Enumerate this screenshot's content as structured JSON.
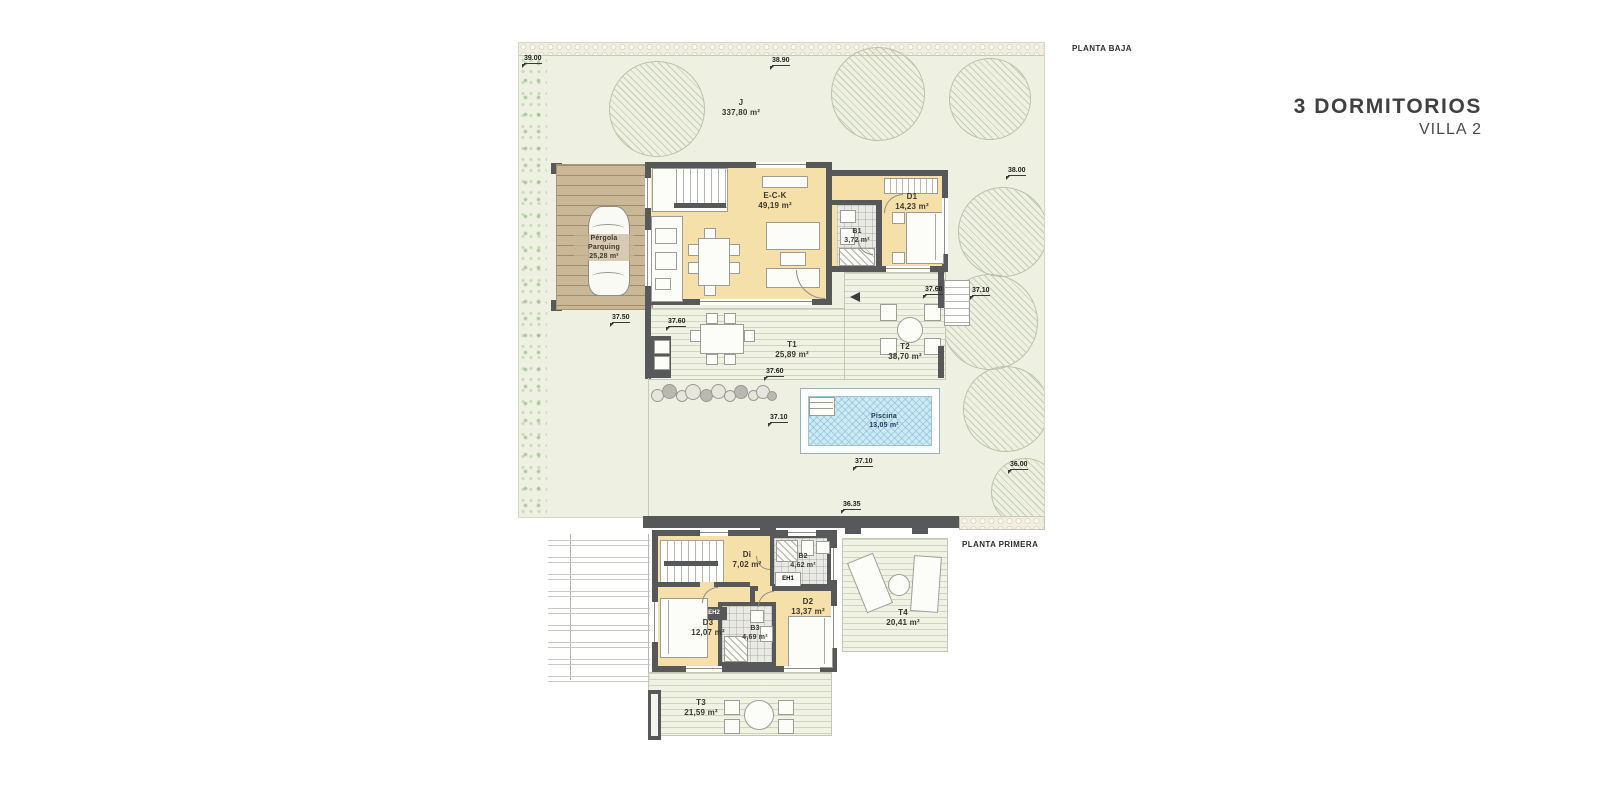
{
  "title": {
    "line1": "3 DORMITORIOS",
    "line2": "VILLA 2"
  },
  "ground_floor": {
    "label": "PLANTA BAJA",
    "rooms": {
      "garden": {
        "name": "J",
        "area": "337,80 m²"
      },
      "pergola": {
        "name": "Pérgola",
        "name2": "Parquing",
        "area": "25,28 m²"
      },
      "living": {
        "name": "E-C-K",
        "area": "49,19 m²"
      },
      "bedroom1": {
        "name": "D1",
        "area": "14,23 m²"
      },
      "bath1": {
        "name": "B1",
        "area": "3,72 m²"
      },
      "terrace1": {
        "name": "T1",
        "area": "25,89 m²"
      },
      "terrace2": {
        "name": "T2",
        "area": "38,70 m²"
      },
      "pool": {
        "name": "Piscina",
        "area": "13,05 m²"
      }
    },
    "dimensions": [
      {
        "label": "39.00",
        "x": 524,
        "y": 55
      },
      {
        "label": "38.90",
        "x": 772,
        "y": 57
      },
      {
        "label": "38.00",
        "x": 1008,
        "y": 167
      },
      {
        "label": "37.60",
        "x": 925,
        "y": 286
      },
      {
        "label": "37.10",
        "x": 972,
        "y": 287
      },
      {
        "label": "37.50",
        "x": 612,
        "y": 314
      },
      {
        "label": "37.60",
        "x": 668,
        "y": 318
      },
      {
        "label": "37.60",
        "x": 766,
        "y": 368
      },
      {
        "label": "37.10",
        "x": 770,
        "y": 414
      },
      {
        "label": "37.10",
        "x": 855,
        "y": 458
      },
      {
        "label": "36.00",
        "x": 1010,
        "y": 461
      },
      {
        "label": "36.35",
        "x": 843,
        "y": 501
      }
    ]
  },
  "first_floor": {
    "label": "PLANTA PRIMERA",
    "rooms": {
      "hall": {
        "name": "Di",
        "area": "7,02 m²"
      },
      "bath2": {
        "name": "B2",
        "area": "4,62 m²"
      },
      "bath3": {
        "name": "B3",
        "area": "4,69 m²"
      },
      "bedroom2": {
        "name": "D2",
        "area": "13,37 m²"
      },
      "bedroom3": {
        "name": "D3",
        "area": "12,07 m²"
      },
      "terrace3": {
        "name": "T3",
        "area": "21,59 m²"
      },
      "terrace4": {
        "name": "T4",
        "area": "20,41 m²"
      },
      "closet1": "EH1",
      "closet2": "EH2"
    }
  },
  "colors": {
    "wall": "#57585a",
    "room_fill": "#f6e0aa",
    "garden": "#eef1e2",
    "deck": "#f0f2e3",
    "pergola": "#cab795",
    "pool_water": "#cdeaf4",
    "pool_text": "#1d3e63",
    "title_text": "#404042"
  }
}
